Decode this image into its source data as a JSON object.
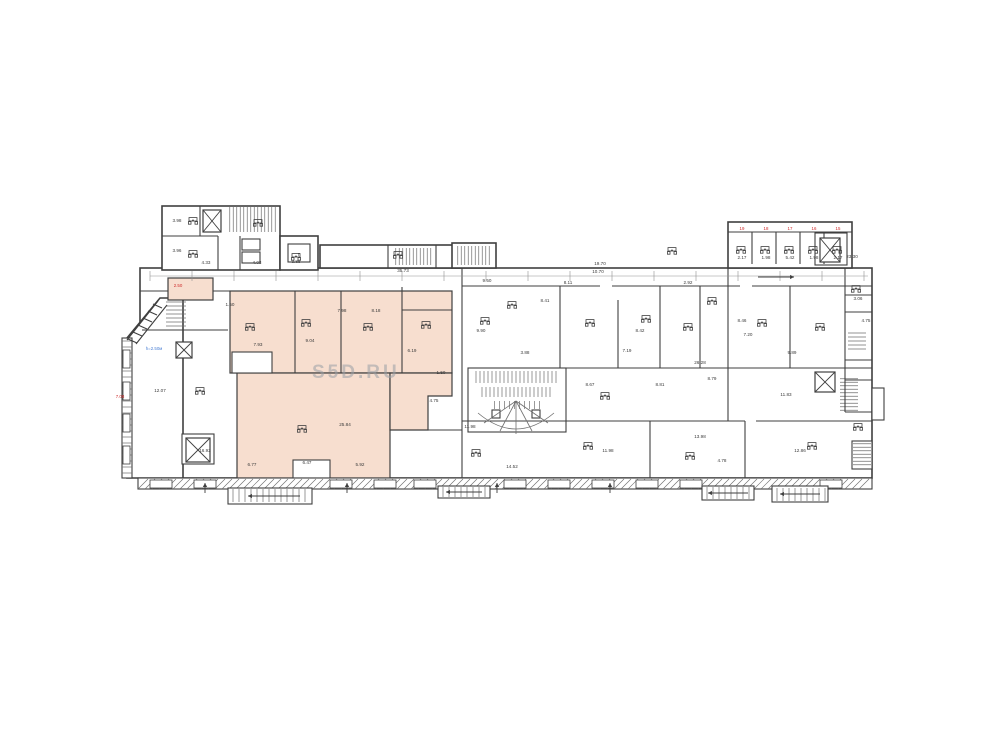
{
  "watermark": {
    "text": "S5D.RU"
  },
  "colors": {
    "wall": "#3f3f3f",
    "thin": "#6f6f6f",
    "dim": "#909090",
    "highlight": "#f7decf",
    "red": "#cf2b2b",
    "blue": "#4a7fd4",
    "label": "#3a3a3a",
    "paper": "#ffffff"
  },
  "plan": {
    "base_rects": [
      [
        140,
        268,
        732,
        210
      ],
      [
        162,
        206,
        118,
        64
      ],
      [
        280,
        236,
        38,
        34
      ],
      [
        320,
        245,
        142,
        23
      ],
      [
        452,
        243,
        44,
        25
      ],
      [
        728,
        222,
        124,
        46
      ]
    ],
    "base_polys": [
      {
        "pts": "127,338 160,298 183,298 183,478 127,478",
        "f": "#ffffff"
      }
    ],
    "fills": [
      {
        "t": "rect",
        "v": [
          168,
          278,
          45,
          22
        ]
      },
      {
        "t": "rect",
        "v": [
          230,
          291,
          222,
          82
        ]
      },
      {
        "t": "rect",
        "v": [
          237,
          373,
          153,
          105
        ]
      },
      {
        "t": "poly",
        "pts": "390,373 452,373 452,396 428,396 428,430 390,430"
      }
    ],
    "over_rects": [
      [
        293,
        460,
        37,
        18
      ],
      [
        232,
        352,
        40,
        21
      ],
      [
        468,
        368,
        98,
        64
      ],
      [
        815,
        233,
        32,
        32
      ],
      [
        242,
        239,
        18,
        11
      ],
      [
        242,
        252,
        18,
        11
      ],
      [
        288,
        244,
        22,
        18
      ],
      [
        182,
        434,
        32,
        30
      ],
      [
        492,
        410,
        8,
        8
      ],
      [
        532,
        410,
        8,
        8
      ],
      [
        872,
        388,
        12,
        32
      ],
      [
        138,
        478,
        734,
        11
      ],
      [
        122,
        338,
        10,
        140
      ]
    ],
    "top_rects": [
      [
        228,
        488,
        84,
        16
      ],
      [
        438,
        486,
        52,
        12
      ],
      [
        702,
        486,
        52,
        14
      ],
      [
        772,
        486,
        56,
        16
      ],
      [
        852,
        441,
        20,
        28
      ]
    ],
    "hatches1": [
      [
        228,
        207,
        50,
        25,
        "v",
        3.5
      ],
      [
        394,
        248,
        40,
        17,
        "v",
        3.5
      ],
      [
        456,
        246,
        36,
        19,
        "v",
        3.5
      ],
      [
        474,
        371,
        86,
        12,
        "v",
        4
      ],
      [
        480,
        387,
        74,
        10,
        "v",
        4
      ],
      [
        492,
        401,
        50,
        8,
        "v",
        5
      ],
      [
        840,
        377,
        18,
        34,
        "h",
        3.5
      ],
      [
        848,
        331,
        18,
        20,
        "h",
        4
      ],
      [
        166,
        300,
        20,
        28,
        "h",
        4
      ],
      [
        138,
        479,
        734,
        10,
        "d",
        7
      ],
      [
        122,
        338,
        10,
        140,
        "h",
        6
      ]
    ],
    "hatches2": [
      [
        230,
        489,
        80,
        13,
        "v",
        6
      ],
      [
        440,
        487,
        48,
        10,
        "v",
        6
      ],
      [
        704,
        487,
        48,
        12,
        "v",
        6
      ],
      [
        774,
        488,
        52,
        13,
        "v",
        6
      ],
      [
        853,
        442,
        18,
        26,
        "h",
        3.5
      ]
    ],
    "windows": [
      [
        150,
        480,
        22,
        8
      ],
      [
        194,
        480,
        22,
        8
      ],
      [
        330,
        480,
        22,
        8
      ],
      [
        374,
        480,
        22,
        8
      ],
      [
        414,
        480,
        22,
        8
      ],
      [
        504,
        480,
        22,
        8
      ],
      [
        548,
        480,
        22,
        8
      ],
      [
        592,
        480,
        22,
        8
      ],
      [
        636,
        480,
        22,
        8
      ],
      [
        680,
        480,
        22,
        8
      ],
      [
        820,
        480,
        22,
        8
      ],
      [
        123,
        350,
        7,
        18
      ],
      [
        123,
        382,
        7,
        18
      ],
      [
        123,
        414,
        7,
        18
      ],
      [
        123,
        446,
        7,
        18
      ]
    ],
    "lines": [
      [
        295,
        291,
        295,
        373
      ],
      [
        341,
        291,
        341,
        373
      ],
      [
        402,
        287,
        402,
        373
      ],
      [
        402,
        310,
        452,
        310
      ],
      [
        462,
        286,
        600,
        286
      ],
      [
        612,
        286,
        740,
        286
      ],
      [
        752,
        286,
        872,
        286
      ],
      [
        140,
        291,
        168,
        291
      ],
      [
        213,
        291,
        230,
        291
      ],
      [
        462,
        268,
        462,
        478
      ],
      [
        560,
        286,
        560,
        368
      ],
      [
        618,
        300,
        618,
        368
      ],
      [
        660,
        286,
        660,
        368
      ],
      [
        700,
        286,
        700,
        368
      ],
      [
        728,
        268,
        728,
        421
      ],
      [
        790,
        286,
        790,
        368
      ],
      [
        566,
        368,
        872,
        368
      ],
      [
        428,
        430,
        462,
        430
      ],
      [
        462,
        421,
        745,
        421
      ],
      [
        756,
        421,
        872,
        421
      ],
      [
        650,
        421,
        650,
        478
      ],
      [
        745,
        421,
        745,
        478
      ],
      [
        845,
        268,
        845,
        412
      ],
      [
        845,
        295,
        872,
        295
      ],
      [
        845,
        312,
        872,
        312
      ],
      [
        845,
        360,
        872,
        360
      ],
      [
        845,
        380,
        872,
        380
      ],
      [
        845,
        412,
        872,
        412
      ],
      [
        200,
        206,
        200,
        236
      ],
      [
        162,
        236,
        218,
        236
      ],
      [
        218,
        236,
        218,
        270
      ],
      [
        240,
        236,
        240,
        270
      ],
      [
        388,
        245,
        388,
        268
      ],
      [
        436,
        245,
        436,
        268
      ],
      [
        752,
        232,
        752,
        264
      ],
      [
        776,
        232,
        776,
        264
      ],
      [
        800,
        232,
        800,
        264
      ],
      [
        824,
        232,
        824,
        264
      ],
      [
        728,
        232,
        852,
        232
      ],
      [
        142,
        330,
        228,
        330
      ],
      [
        127,
        340,
        158,
        301
      ],
      [
        136,
        344,
        167,
        305
      ],
      [
        128,
        339,
        137,
        343
      ],
      [
        133,
        332,
        142,
        336
      ],
      [
        138,
        325,
        147,
        329
      ],
      [
        143,
        318,
        152,
        322
      ],
      [
        148,
        311,
        157,
        315
      ],
      [
        153,
        304,
        162,
        308
      ],
      [
        150,
        276,
        868,
        276,
        0.5,
        "#909090"
      ]
    ],
    "ticks": {
      "y": 276,
      "half": 5,
      "xs": [
        150,
        192,
        234,
        276,
        318,
        360,
        402,
        444,
        486,
        528,
        570,
        612,
        654,
        696,
        738,
        780,
        822,
        864
      ]
    },
    "elevators": [
      [
        203,
        210,
        18,
        22
      ],
      [
        820,
        238,
        20,
        24
      ],
      [
        176,
        342,
        16,
        16
      ],
      [
        186,
        438,
        24,
        24
      ],
      [
        815,
        372,
        20,
        20
      ]
    ],
    "paths": [
      {
        "d": "M478,413 Q516,445 554,413"
      },
      {
        "d": "M516,401 L484,423"
      },
      {
        "d": "M516,401 L500,431},"
      },
      {
        "d": "M516,401 L516,434"
      },
      {
        "d": "M516,401 L532,431"
      },
      {
        "d": "M516,401 L548,423"
      }
    ],
    "arrows": [
      [
        300,
        496,
        248,
        496
      ],
      [
        482,
        492,
        446,
        492
      ],
      [
        748,
        493,
        708,
        493
      ],
      [
        820,
        494,
        780,
        494
      ],
      [
        758,
        277,
        794,
        277
      ],
      [
        205,
        493,
        205,
        483
      ],
      [
        347,
        493,
        347,
        483
      ],
      [
        497,
        493,
        497,
        483
      ],
      [
        610,
        493,
        610,
        483
      ]
    ],
    "furniture": [
      [
        193,
        220
      ],
      [
        193,
        253
      ],
      [
        258,
        222
      ],
      [
        296,
        256
      ],
      [
        398,
        254
      ],
      [
        672,
        250
      ],
      [
        250,
        326
      ],
      [
        306,
        322
      ],
      [
        368,
        326
      ],
      [
        426,
        324
      ],
      [
        485,
        320
      ],
      [
        512,
        304
      ],
      [
        590,
        322
      ],
      [
        646,
        318
      ],
      [
        688,
        326
      ],
      [
        712,
        300
      ],
      [
        762,
        322
      ],
      [
        820,
        326
      ],
      [
        856,
        288
      ],
      [
        605,
        395
      ],
      [
        588,
        445
      ],
      [
        690,
        455
      ],
      [
        812,
        445
      ],
      [
        302,
        428
      ],
      [
        200,
        390
      ],
      [
        476,
        452
      ],
      [
        858,
        426
      ],
      [
        741,
        249
      ],
      [
        765,
        249
      ],
      [
        789,
        249
      ],
      [
        813,
        249
      ],
      [
        837,
        249
      ]
    ],
    "texts": [
      [
        177,
        222,
        "3.98"
      ],
      [
        177,
        252,
        "3.96"
      ],
      [
        206,
        264,
        "4.33"
      ],
      [
        257,
        264,
        "4.03"
      ],
      [
        296,
        263,
        "3.88"
      ],
      [
        403,
        272,
        "35.73"
      ],
      [
        600,
        265,
        "19.70"
      ],
      [
        598,
        273,
        "10.70"
      ],
      [
        852,
        258,
        "23.30"
      ],
      [
        742,
        259,
        "2.17"
      ],
      [
        766,
        259,
        "1.98"
      ],
      [
        790,
        259,
        "5.42"
      ],
      [
        814,
        259,
        "1.98"
      ],
      [
        838,
        259,
        "2.17"
      ],
      [
        742,
        230,
        "19",
        "red"
      ],
      [
        766,
        230,
        "18",
        "red"
      ],
      [
        790,
        230,
        "17",
        "red"
      ],
      [
        814,
        230,
        "16",
        "red"
      ],
      [
        838,
        230,
        "15",
        "red"
      ],
      [
        120,
        398,
        "7.08",
        "red"
      ],
      [
        178,
        287,
        "2.50",
        "red"
      ],
      [
        154,
        350,
        "h=2.50м",
        "blue"
      ],
      [
        299,
        256,
        "Г"
      ],
      [
        487,
        282,
        "9.50"
      ],
      [
        545,
        302,
        "8.41"
      ],
      [
        481,
        332,
        "9.90"
      ],
      [
        568,
        284,
        "8.11"
      ],
      [
        640,
        332,
        "8.42"
      ],
      [
        627,
        352,
        "7.19"
      ],
      [
        688,
        284,
        "2.92"
      ],
      [
        742,
        322,
        "8.46"
      ],
      [
        748,
        336,
        "7.20"
      ],
      [
        792,
        354,
        "9.89"
      ],
      [
        700,
        364,
        "26.28"
      ],
      [
        712,
        380,
        "8.79"
      ],
      [
        590,
        386,
        "8.67"
      ],
      [
        660,
        386,
        "8.81"
      ],
      [
        786,
        396,
        "11.83"
      ],
      [
        608,
        452,
        "11.98"
      ],
      [
        700,
        438,
        "13.98"
      ],
      [
        722,
        462,
        "4.78"
      ],
      [
        800,
        452,
        "12.86"
      ],
      [
        470,
        428,
        "11.98"
      ],
      [
        512,
        468,
        "14.52"
      ],
      [
        434,
        402,
        "4.75"
      ],
      [
        412,
        352,
        "6.19"
      ],
      [
        376,
        312,
        "8.18"
      ],
      [
        342,
        312,
        "7.98"
      ],
      [
        310,
        342,
        "9.04"
      ],
      [
        258,
        346,
        "7.93"
      ],
      [
        345,
        426,
        "25.84"
      ],
      [
        252,
        466,
        "6.77"
      ],
      [
        360,
        466,
        "5.92"
      ],
      [
        307,
        464,
        "6.47"
      ],
      [
        205,
        452,
        "16.92"
      ],
      [
        160,
        392,
        "12.07"
      ],
      [
        866,
        322,
        "4.75"
      ],
      [
        858,
        300,
        "3.06"
      ],
      [
        230,
        306,
        "1.50"
      ],
      [
        441,
        374,
        "1.50"
      ],
      [
        525,
        354,
        "3.88"
      ]
    ]
  }
}
